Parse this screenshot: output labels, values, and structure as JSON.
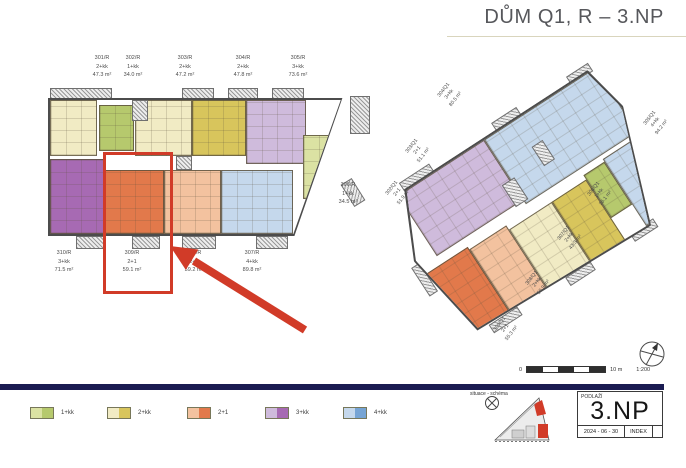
{
  "title": "DŮM Q1, R – 3.NP",
  "plans": {
    "r": {
      "top_units": [
        {
          "id": "301/R",
          "type": "2+kk",
          "area": "47.3 m²"
        },
        {
          "id": "302/R",
          "type": "1+kk",
          "area": "34.0 m²"
        },
        {
          "id": "303/R",
          "type": "2+kk",
          "area": "47.2 m²"
        },
        {
          "id": "304/R",
          "type": "2+kk",
          "area": "47.8 m²"
        },
        {
          "id": "305/R",
          "type": "3+kk",
          "area": "73.6 m²"
        }
      ],
      "bottom_units": [
        {
          "id": "310/R",
          "type": "3+kk",
          "area": "71.5 m²"
        },
        {
          "id": "309/R",
          "type": "2+1",
          "area": "59.1 m²"
        },
        {
          "id": "308/R",
          "type": "2+1",
          "area": "59.2 m²"
        },
        {
          "id": "307/R",
          "type": "4+kk",
          "area": "89.8 m²"
        }
      ],
      "side_unit": {
        "id": "306/R",
        "type": "1+kk",
        "area": "34.5 m²"
      },
      "highlighted_unit": "309/R"
    },
    "q1": {
      "labels": [
        {
          "id": "302/Q1",
          "type": "2+1",
          "area": "51.9 m²"
        },
        {
          "id": "303/Q1",
          "type": "2+1",
          "area": "51.1 m²"
        },
        {
          "id": "304/Q1",
          "type": "3+kk",
          "area": "80.5 m²"
        },
        {
          "id": "305/Q1",
          "type": "4+kk",
          "area": "94.2 m²"
        },
        {
          "id": "306/Q1",
          "type": "1+kk",
          "area": "36.1 m²"
        },
        {
          "id": "307/Q1",
          "type": "2+kk",
          "area": "43.3 m²"
        },
        {
          "id": "308/Q1",
          "type": "2+kk",
          "area": "50.9 m²"
        },
        {
          "id": "309/Q1",
          "type": "2+1",
          "area": "55.3 m²"
        }
      ]
    }
  },
  "scale_bar": {
    "start": "0",
    "end": "10 m",
    "ratio": "1:200"
  },
  "legend": [
    {
      "label": "1+kk",
      "light": "#dbe2a3",
      "dark": "#b6c96d"
    },
    {
      "label": "2+kk",
      "light": "#f1ebc4",
      "dark": "#d8c55c"
    },
    {
      "label": "2+1",
      "light": "#f3c29f",
      "dark": "#e2794b"
    },
    {
      "label": "3+kk",
      "light": "#cfbbdc",
      "dark": "#a76ab3"
    },
    {
      "label": "4+kk",
      "light": "#c5d8ec",
      "dark": "#76a4d4"
    }
  ],
  "site_schema": {
    "label": "situace - schéma"
  },
  "title_block": {
    "field_label": "PODLAŽÍ",
    "floor": "3.NP",
    "date": "2024 - 06 - 30",
    "index_label": "INDEX"
  },
  "colors": {
    "accent_red": "#d13b28",
    "navy": "#1b1c52"
  }
}
